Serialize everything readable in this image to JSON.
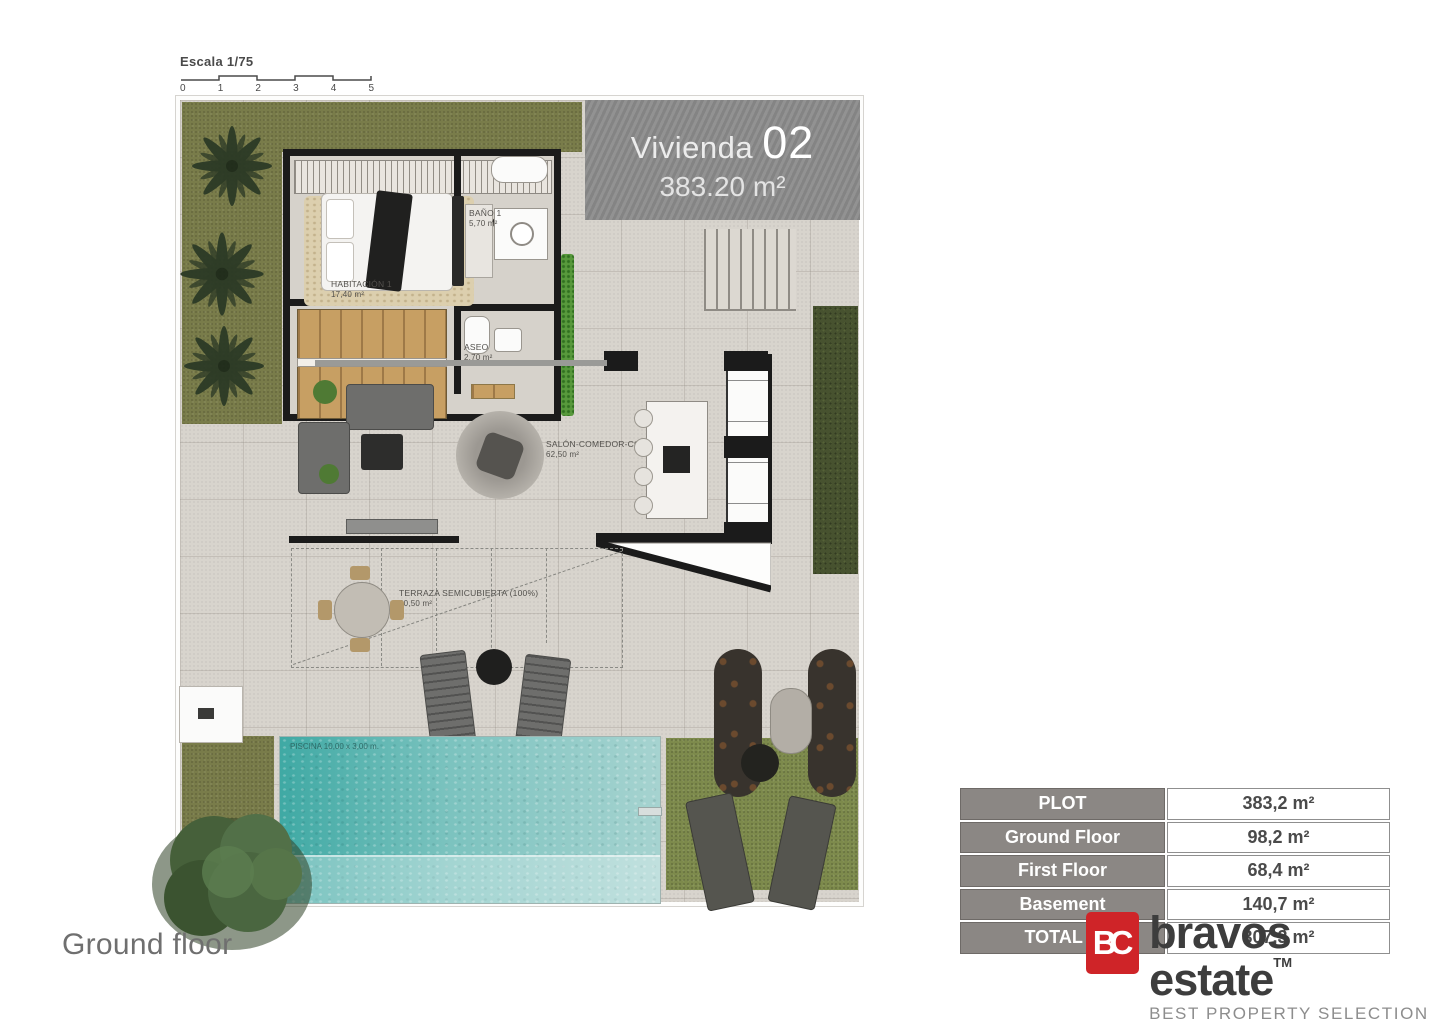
{
  "scale_bar": {
    "label": "Escala 1/75",
    "ticks": [
      "0",
      "1",
      "2",
      "3",
      "4",
      "5"
    ]
  },
  "banner": {
    "title": "Vivienda",
    "number": "02",
    "area": "383.20 m²"
  },
  "plan": {
    "floor_label": "Ground floor",
    "rooms": [
      {
        "name": "HABITACIÓN 1",
        "area": "17,40 m²"
      },
      {
        "name": "BAÑO 1",
        "area": "5,70 m²"
      },
      {
        "name": "ASEO",
        "area": "2,70 m²"
      },
      {
        "name": "SALÓN-COMEDOR-COCINA",
        "area": "62,50 m²"
      },
      {
        "name": "TERRAZA SEMICUBIERTA (100%)",
        "area": "20,50 m²"
      }
    ],
    "pool_label": "PISCINA 10,00 x 3,00 m."
  },
  "summary_table": {
    "rows": [
      {
        "label": "PLOT",
        "value": "383,2 m²"
      },
      {
        "label": "Ground Floor",
        "value": "98,2 m²"
      },
      {
        "label": "First Floor",
        "value": "68,4 m²"
      },
      {
        "label": "Basement",
        "value": "140,7 m²"
      },
      {
        "label": "TOTAL B",
        "value": "307,3 m²"
      }
    ]
  },
  "logo": {
    "monogram": "BC",
    "name": "bravos estate",
    "trademark": "TM",
    "tagline": "BEST PROPERTY SELECTION"
  },
  "colors": {
    "accent_red": "#cf2428",
    "banner_gray": "#8c8c8c",
    "table_header_gray": "#8b8784",
    "pool_teal": "#3fa9a4",
    "grass_olive": "#797c4a",
    "paving": "#d8d4cd"
  }
}
